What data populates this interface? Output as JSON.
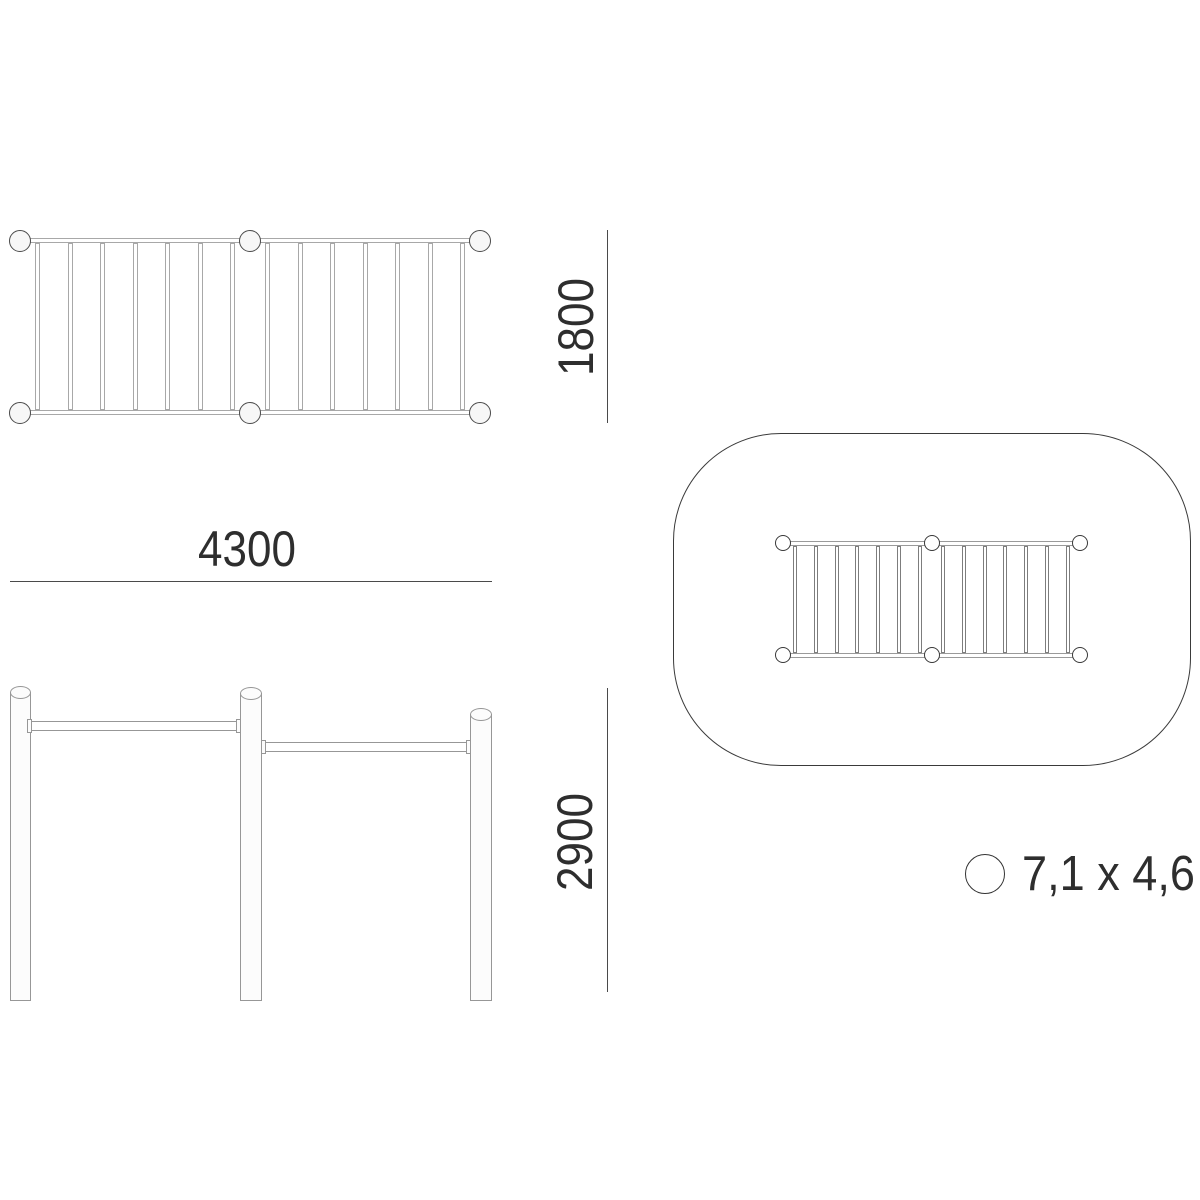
{
  "dimensions": {
    "width": "4300",
    "depth": "1800",
    "height": "2900"
  },
  "footprint": {
    "label": "7,1 x 4,6",
    "symbol": "circle"
  },
  "structure": {
    "plan_view": {
      "post_count": 6,
      "section_count": 2,
      "rungs_per_section": 7
    },
    "elevation_view": {
      "post_count": 3,
      "bar_count": 2
    },
    "safety_zone_plan": {
      "post_count": 6,
      "section_count": 2,
      "rungs_per_section": 7
    }
  },
  "colors": {
    "background": "#ffffff",
    "plan_line": "#a8a8a8",
    "elevation_line": "#979797",
    "outline_dark": "#3a3a3a",
    "dimension_line": "#4a4a4a",
    "text": "#2e2e2e",
    "post_fill": "#f7f7f7"
  }
}
